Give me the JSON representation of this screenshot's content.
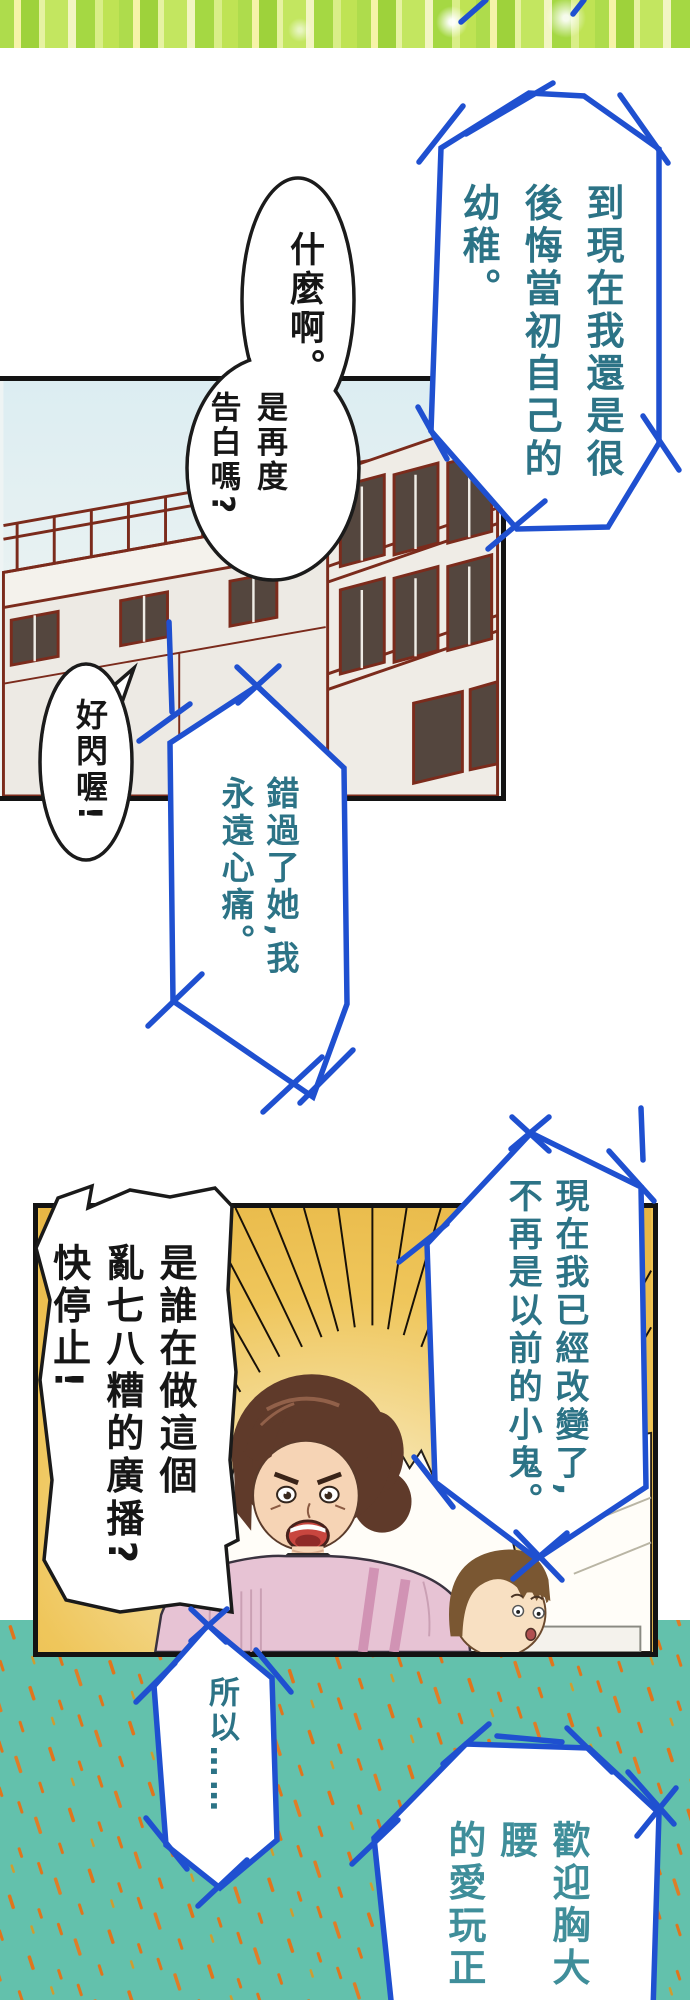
{
  "page": {
    "kind": "vertical manga strip",
    "width": 690,
    "height": 2000
  },
  "speech": {
    "regret": "到現在我還是很\n後悔當初自己的\n幼稚。",
    "what": "什麼啊。",
    "confess": "是再度\n告白嗎?",
    "shine": "好閃喔!",
    "missed": "錯過了她,我\n永遠心痛。",
    "changed": "現在我已經改變了,\n不再是以前的小鬼。",
    "who": "是誰在做這個\n亂七八糟的廣播?\n快停止!",
    "so": "所以……",
    "welcome": "歡迎胸大腰\n的愛玩正妹\n療心痛喔—"
  },
  "figures": {
    "panel_building_alt": "tilted line-art of a school building with rooftop railing and windows",
    "panel_burst_alt": "angry woman shouting beside a startled boy on a yellow speed-line burst",
    "banner_alt": "green and yellow striped sparkle banner"
  },
  "colors": {
    "bubble_stroke_blue": "#1f50d0",
    "bubble_fill": "#ffffff",
    "white_bubble_stroke": "#1b1b1b",
    "teal_text": "#2c7386",
    "teal_text_bottom": "#3f8e9a",
    "black_text": "#161616",
    "building_line": "#7b2b1c",
    "building_window": "#54463e",
    "sky": "#e2eff3",
    "burst_yellow": "#eec252",
    "burst_center": "#f9f1d2",
    "teal_background": "#63c1ac",
    "sparkle_orange": "#e0751c",
    "banner_green": "#9ed23b",
    "banner_yellow": "#f6f3a8",
    "woman_hair": "#5f3a2a",
    "woman_skin": "#f6d4b5",
    "woman_sweater": "#e7c3d4",
    "woman_strap": "#d193b4",
    "woman_mouth": "#c8463f",
    "boy_hair": "#7a5732",
    "boy_skin": "#f8e0c2",
    "panel_border": "#131313"
  }
}
